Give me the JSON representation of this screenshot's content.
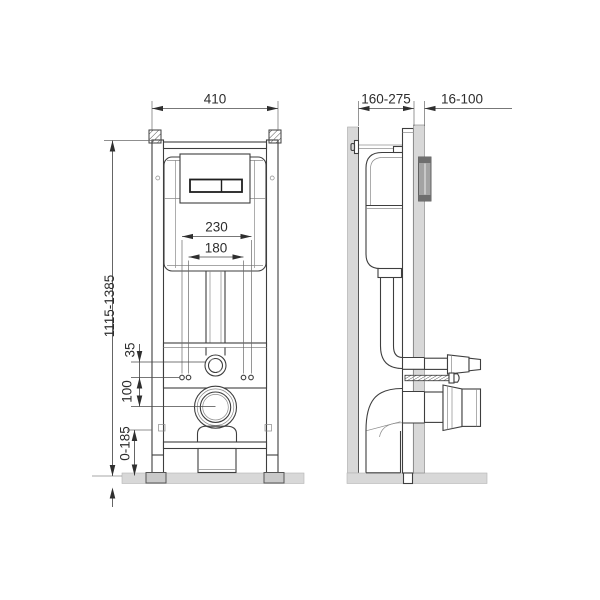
{
  "drawing": {
    "title": "wc-concealed-installation-frame-dimension-drawing",
    "front_view": {
      "dim_width": "410",
      "dim_height": "1115-1385",
      "dim_fixing_outer": "230",
      "dim_fixing_inner": "180",
      "dim_flush_offset": "35",
      "dim_outlet_offset": "100",
      "dim_foot_adjust": "0-185"
    },
    "side_view": {
      "dim_depth": "160-275",
      "dim_wall_thickness": "16-100"
    },
    "colors": {
      "surface_gray": "#d8d8d8",
      "plate_gray": "#a3a3a3",
      "plate_dark": "#6e6e6e",
      "line": "#3e3e3e",
      "background": "#ffffff"
    }
  }
}
